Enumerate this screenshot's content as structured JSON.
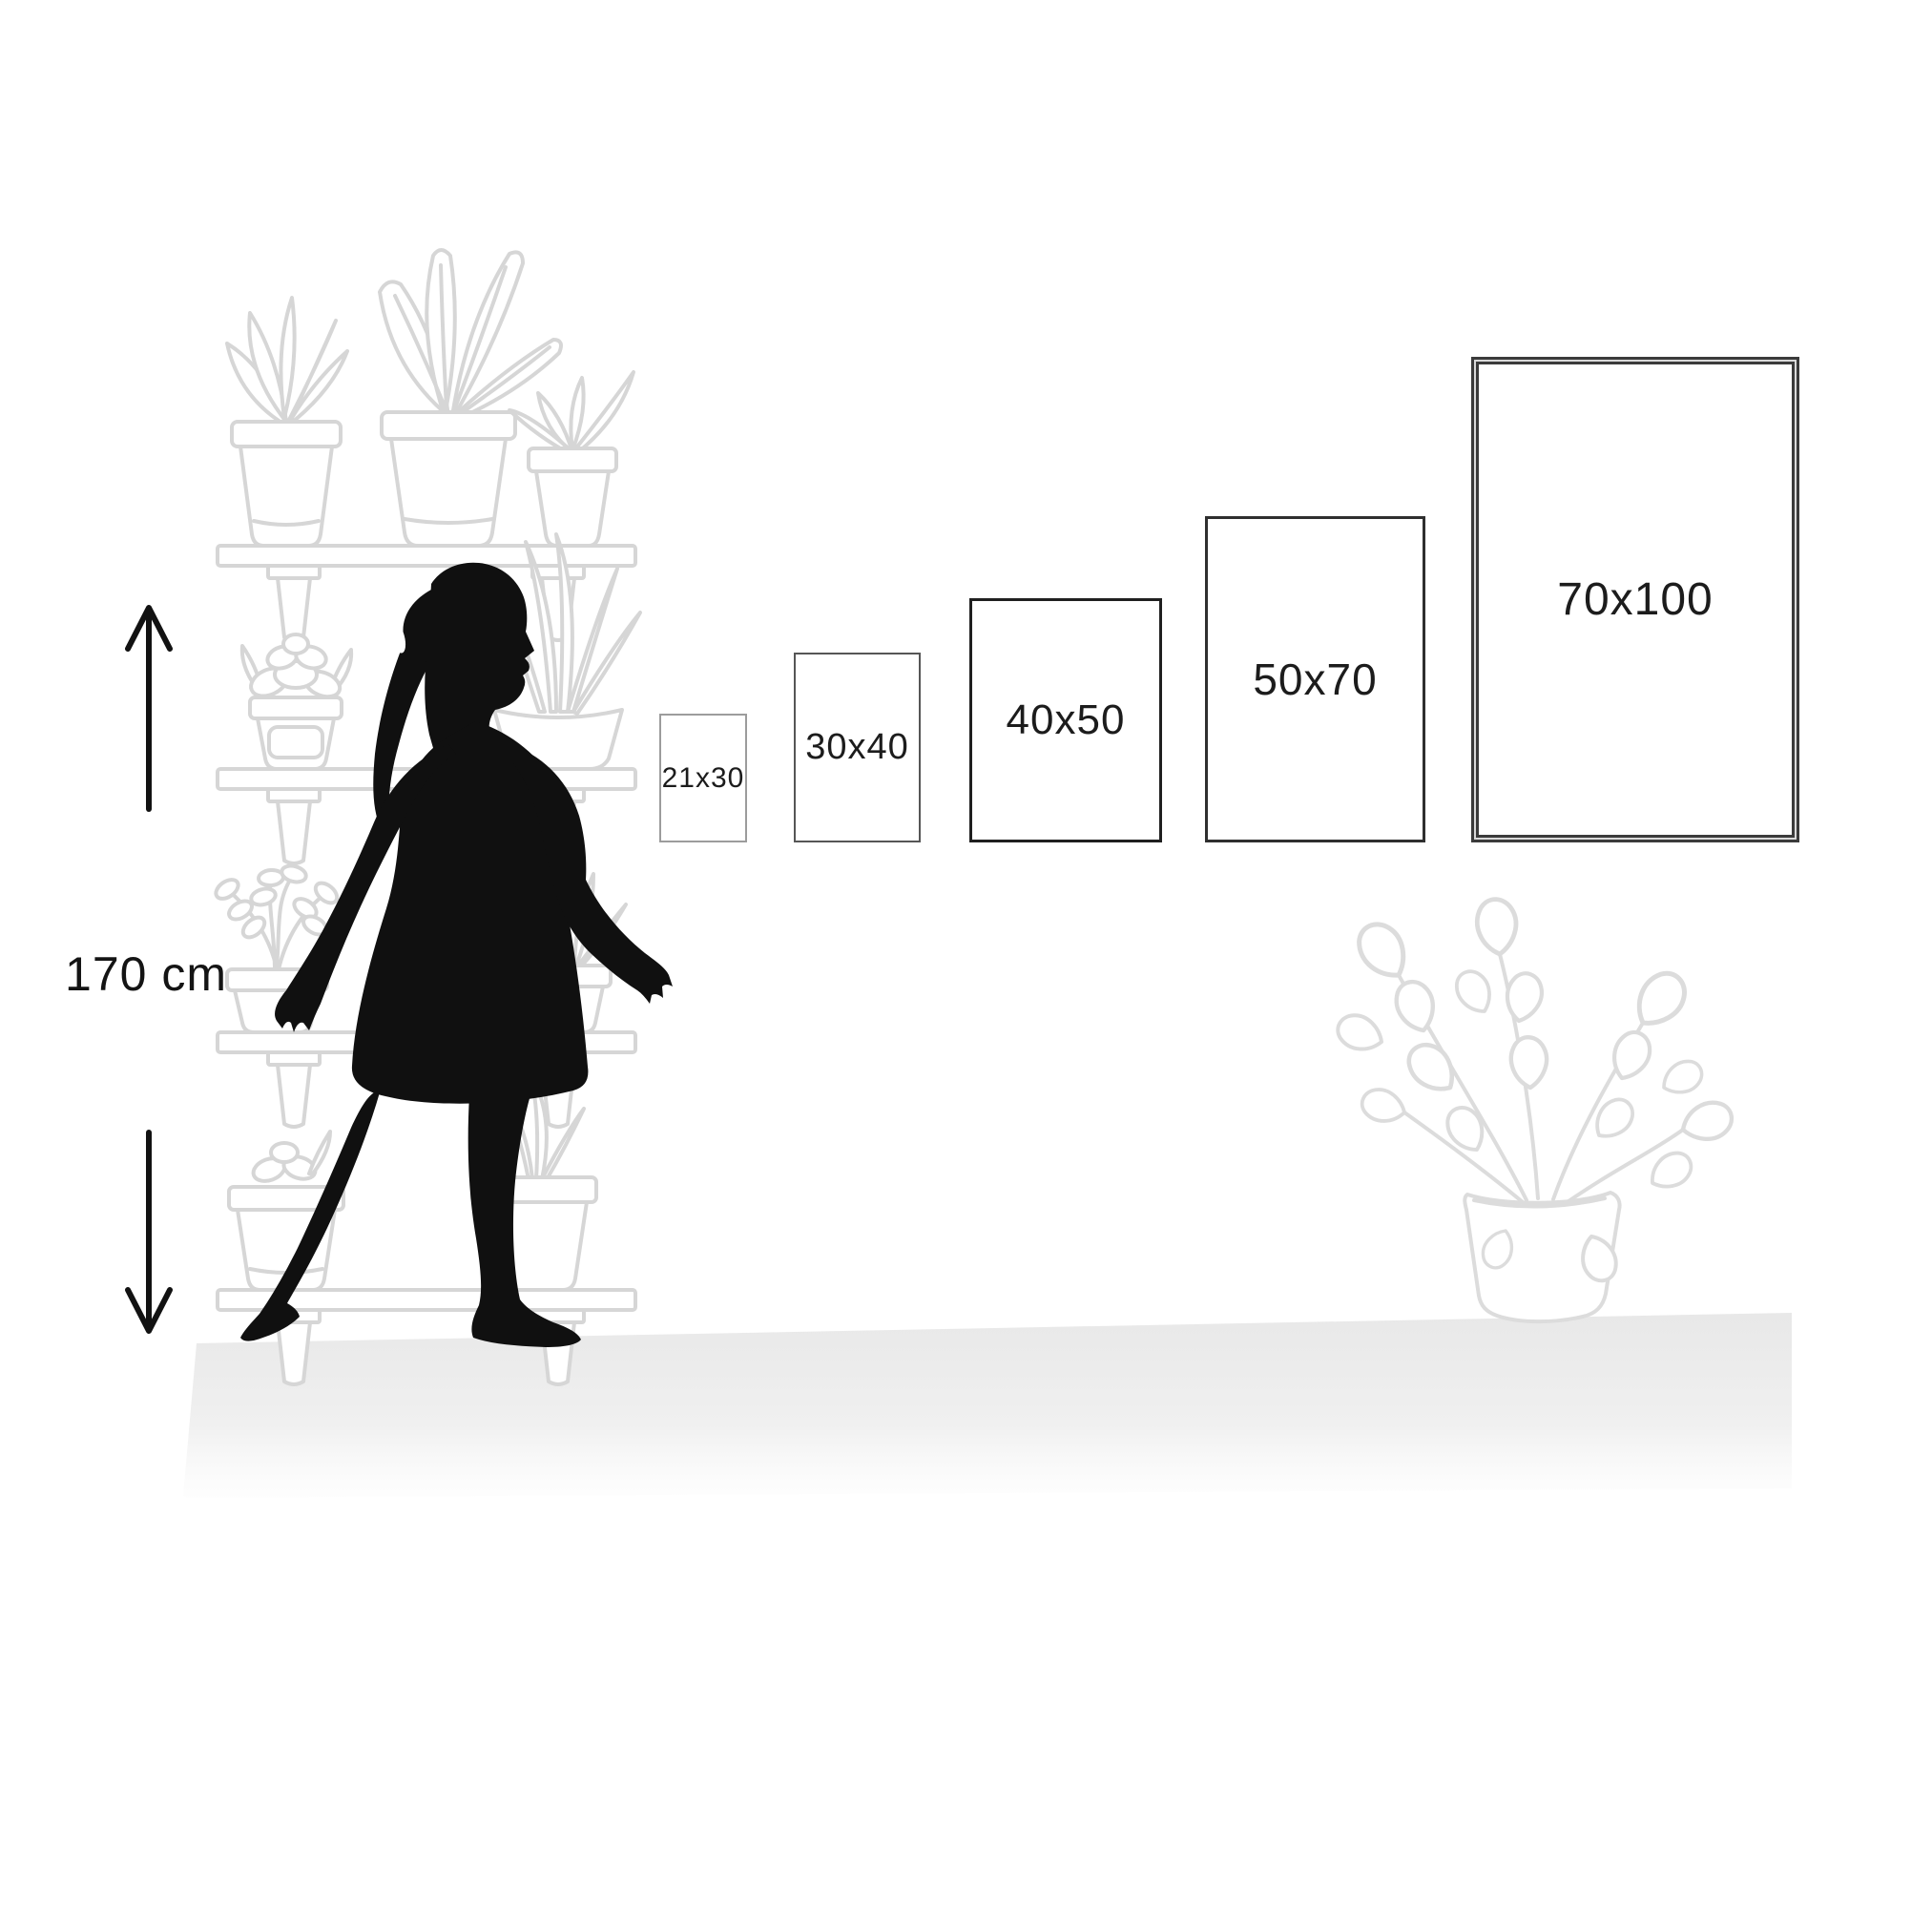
{
  "page": {
    "background": "#ffffff",
    "description": "poster size guide infographic"
  },
  "measurement": {
    "height_label": "170 cm"
  },
  "size_guide": {
    "sizes": [
      {
        "label": "21x30"
      },
      {
        "label": "30x40"
      },
      {
        "label": "40x50"
      },
      {
        "label": "50x70"
      },
      {
        "label": "70x100"
      }
    ]
  },
  "colors": {
    "silhouette": "#101010",
    "arrow": "#121212",
    "shelf_line_art": "#d6d6d6",
    "plant_line_art": "#dcdcdc",
    "floor_shadow": "#e8e8e8",
    "label_text": "#1c1c1c",
    "box_borders": [
      "#9c9c9c",
      "#565656",
      "#1f1f1f",
      "#2f2f2f",
      "#3b3b3b"
    ]
  },
  "decor": {
    "figure": "walking-woman-silhouette",
    "left_illustration": "plant-shelf",
    "right_illustration": "potted-pothos-plant",
    "arrows": [
      "up-arrow",
      "down-arrow"
    ]
  }
}
